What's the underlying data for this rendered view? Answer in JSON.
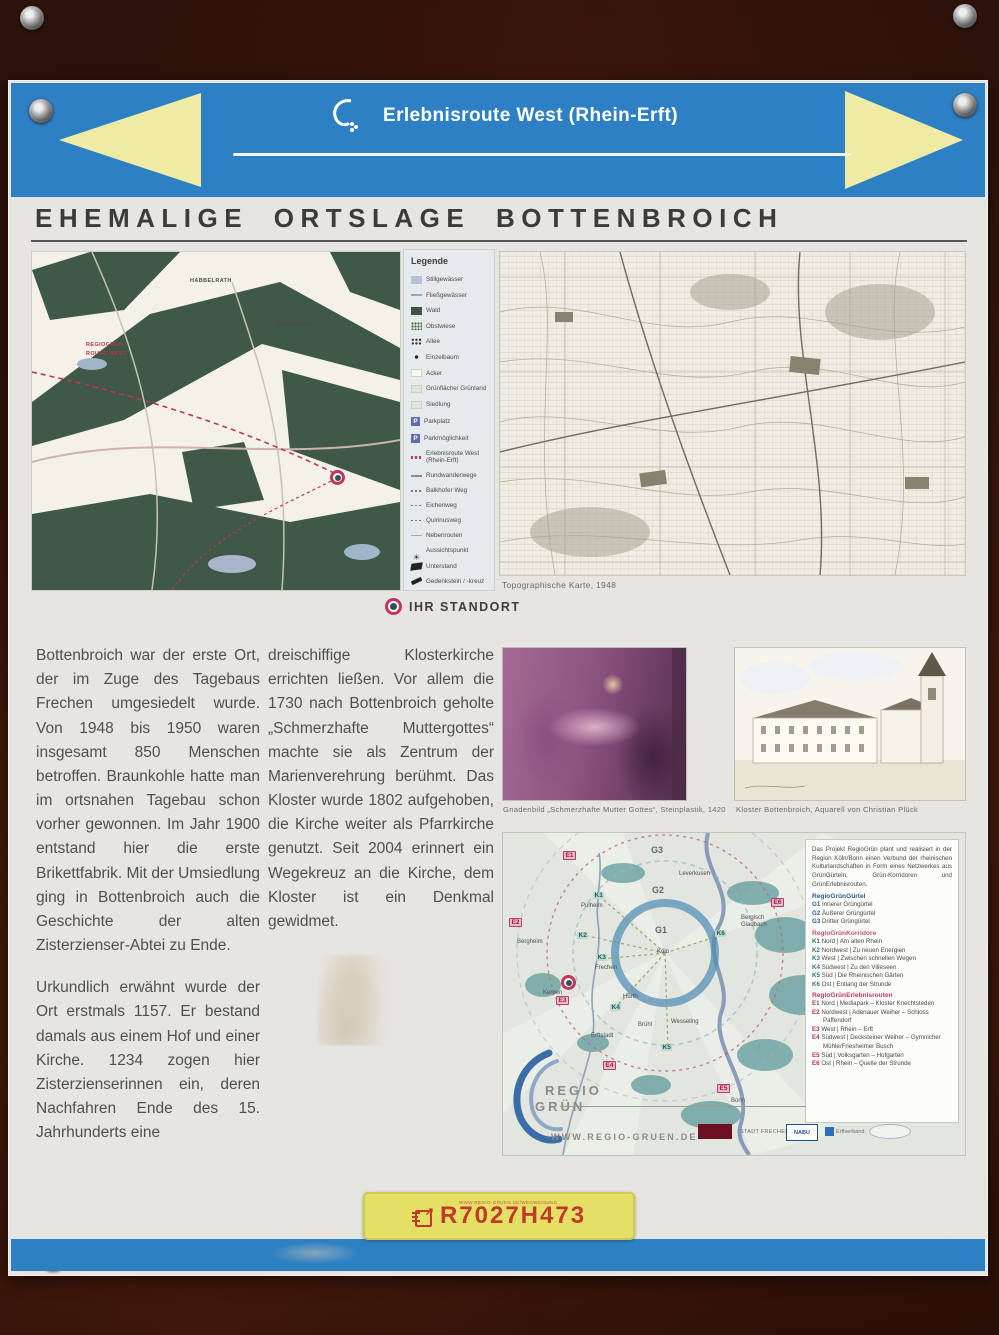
{
  "header": {
    "route_label": "Erlebnisroute West (Rhein-Erft)",
    "title": "EHEMALIGE ORTSLAGE BOTTENBROICH"
  },
  "colors": {
    "band_blue": "#2e80c4",
    "arrow_yellow": "#eeeca4",
    "code_bar_yellow": "#e4e065",
    "code_red": "#c03a2a",
    "route_pink": "#c2355b"
  },
  "legend": {
    "title": "Legende",
    "items": [
      {
        "label": "Stillgewässer"
      },
      {
        "label": "Fließgewässer"
      },
      {
        "label": "Wald"
      },
      {
        "label": "Obstwiese"
      },
      {
        "label": "Allee"
      },
      {
        "label": "Einzelbaum"
      },
      {
        "label": "Acker"
      },
      {
        "label": "Grünfläche/ Grünland"
      },
      {
        "label": "Siedlung"
      },
      {
        "label": "Parkplatz"
      },
      {
        "label": "Parkmöglichkeit"
      },
      {
        "label": "Erlebnisroute West (Rhein-Erft)"
      },
      {
        "label": "Rundwanderwege"
      },
      {
        "label": "Balkhofer Weg"
      },
      {
        "label": "Eichenweg"
      },
      {
        "label": "Quirinusweg"
      },
      {
        "label": "Nebenrouten"
      },
      {
        "label": "Aussichtspunkt"
      },
      {
        "label": "Unterstand"
      },
      {
        "label": "Gedenkstein / -kreuz"
      }
    ]
  },
  "detail_map": {
    "labels": [
      {
        "text": "HABBELRATH"
      },
      {
        "text": "GREFRATH"
      },
      {
        "text": "REGIOGRÜN"
      },
      {
        "text": "ROUTE WEST"
      }
    ]
  },
  "topo_map": {
    "caption": "Topographische Karte, 1948"
  },
  "standort": {
    "label": "IHR STANDORT"
  },
  "article": {
    "col1_p1": "Bottenbroich war der erste Ort, der im Zuge des Tagebaus Frechen umgesiedelt wurde. Von 1948 bis 1950 waren insgesamt 850 Menschen betroffen. Braunkohle hatte man im ortsnahen Tagebau schon vorher gewonnen. Im Jahr 1900 entstand hier die erste Brikettfabrik. Mit der Umsiedlung ging in Bottenbroich auch die Geschichte der alten Zisterzienser-Abtei zu Ende.",
    "col1_p2": "Urkundlich erwähnt wurde der Ort erstmals 1157. Er bestand damals aus einem Hof und einer Kirche. 1234 zogen hier Zisterzienserinnen ein, deren Nachfahren Ende des 15. Jahrhunderts eine",
    "col2_p1": "dreischiffige Klosterkirche errichten ließen. Vor allem die 1730 nach Bottenbroich geholte „Schmerzhafte Muttergottes“ machte sie als Zentrum der Marienverehrung berühmt. Das Kloster wurde 1802 aufgehoben, die Kirche weiter als Pfarrkirche genutzt. Seit 2004 erinnert ein Wegekreuz an die Kirche, dem Kloster ist ein Denkmal gewidmet."
  },
  "figures": {
    "pieta_caption": "Gnadenbild „Schmerzhafte Mutter Gottes“, Steinplastik, 1420",
    "kloster_caption": "Kloster Bottenbroich, Aquarell von Christian Plück"
  },
  "regio": {
    "intro": "Das Projekt RegioGrün plant und realisiert in der Region Köln/Bonn einen Verbund der rheinischen Kulturlandschaften in Form eines Netzwerkes aus GrünGürteln, Grün-Korridoren und GrünErlebnisrouten.",
    "sections": [
      {
        "title": "RegioGrünGürtel",
        "items": [
          {
            "code": "G1",
            "text": "Innerer Grüngürtel"
          },
          {
            "code": "G2",
            "text": "Äußerer Grüngürtel"
          },
          {
            "code": "G3",
            "text": "Dritter Grüngürtel"
          }
        ]
      },
      {
        "title": "RegioGrünKorridore",
        "items": [
          {
            "code": "K1",
            "text": "Nord | Am alten Rhein"
          },
          {
            "code": "K2",
            "text": "Nordwest | Zu neuen Energien"
          },
          {
            "code": "K3",
            "text": "West | Zwischen schnellen Wegen"
          },
          {
            "code": "K4",
            "text": "Südwest | Zu den Villeseen"
          },
          {
            "code": "K5",
            "text": "Süd | Die Rheinischen Gärten"
          },
          {
            "code": "K6",
            "text": "Ost | Entlang der Strunde"
          }
        ]
      },
      {
        "title": "RegioGrünErlebnisrouten",
        "items": [
          {
            "code": "E1",
            "text": "Nord | Mediapark – Kloster Knechtsteden"
          },
          {
            "code": "E2",
            "text": "Nordwest | Adenauer Weiher – Schloss Paffendorf"
          },
          {
            "code": "E3",
            "text": "West | Rhein – Erft"
          },
          {
            "code": "E4",
            "text": "Südwest | Decksteiner Weiher – Gymnicher Mühle/Friesheimer Busch"
          },
          {
            "code": "E5",
            "text": "Süd | Volksgarten – Hofgarten"
          },
          {
            "code": "E6",
            "text": "Ost | Rhein – Quelle der Strunde"
          }
        ]
      }
    ],
    "logo": {
      "line1": "REGIO",
      "line2": "GRÜN"
    },
    "url": "WWW.REGIO-GRUEN.DE",
    "partners": [
      {
        "name": "STADT FRECHEN"
      },
      {
        "name": "NABU"
      },
      {
        "name": "Erftverband"
      }
    ],
    "map": {
      "labels": [
        {
          "text": "G3"
        },
        {
          "text": "G2"
        },
        {
          "text": "G1"
        },
        {
          "text": "Köln"
        },
        {
          "text": "Leverkusen"
        },
        {
          "text": "Pulheim"
        },
        {
          "text": "Bergheim"
        },
        {
          "text": "Frechen"
        },
        {
          "text": "Kerpen"
        },
        {
          "text": "Hürth"
        },
        {
          "text": "Brühl"
        },
        {
          "text": "Wesseling"
        },
        {
          "text": "Erftstadt"
        },
        {
          "text": "Bergisch Gladbach"
        },
        {
          "text": "Bonn"
        },
        {
          "text": "E1"
        },
        {
          "text": "E2"
        },
        {
          "text": "E3"
        },
        {
          "text": "E4"
        },
        {
          "text": "E5"
        },
        {
          "text": "E6"
        },
        {
          "text": "K1"
        },
        {
          "text": "K2"
        },
        {
          "text": "K3"
        },
        {
          "text": "K4"
        },
        {
          "text": "K5"
        },
        {
          "text": "K6"
        }
      ]
    }
  },
  "code_bar": {
    "code": "R7027H473",
    "small_text": "WWW.REGIO-GRUEN.DE/WEGWEISUNG"
  }
}
